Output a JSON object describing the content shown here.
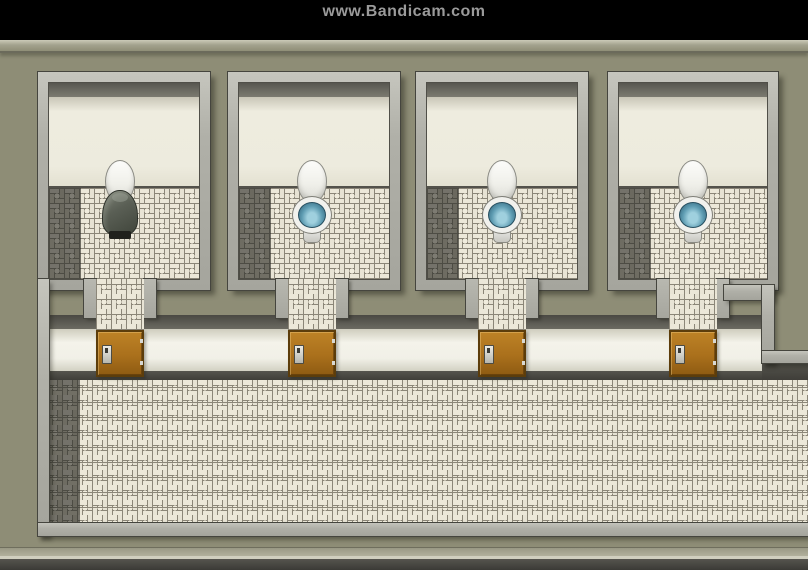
{
  "watermark": {
    "text": "www.Bandicam.com"
  },
  "scene": {
    "type": "rpg-maker-style bathroom map",
    "stalls": [
      {
        "label": "stall-1",
        "toilet": "lid raised",
        "occupied_by": "hooded figure sitting on toilet",
        "door": "closed brown door"
      },
      {
        "label": "stall-2",
        "toilet": "lid raised, blue water visible",
        "occupied_by": null,
        "door": "closed brown door"
      },
      {
        "label": "stall-3",
        "toilet": "lid raised, blue water visible",
        "occupied_by": null,
        "door": "closed brown door"
      },
      {
        "label": "stall-4",
        "toilet": "lid raised, blue water visible",
        "occupied_by": null,
        "door": "closed brown door"
      }
    ],
    "hallway": "tiled corridor along the bottom with dark tile strip on the left"
  },
  "colors": {
    "watermark_gray": "#9a9a9a",
    "olive": "#8e8d76",
    "tile_grout": "#8b8678",
    "darktile_grout": "#4d4c44",
    "water_blue": "#5e9cb2",
    "cloak_gray": "#5a5f55",
    "door_brown": "#aa701c",
    "hall_white": "#f4f3ea",
    "frame_gray": "#b0b0a8"
  }
}
